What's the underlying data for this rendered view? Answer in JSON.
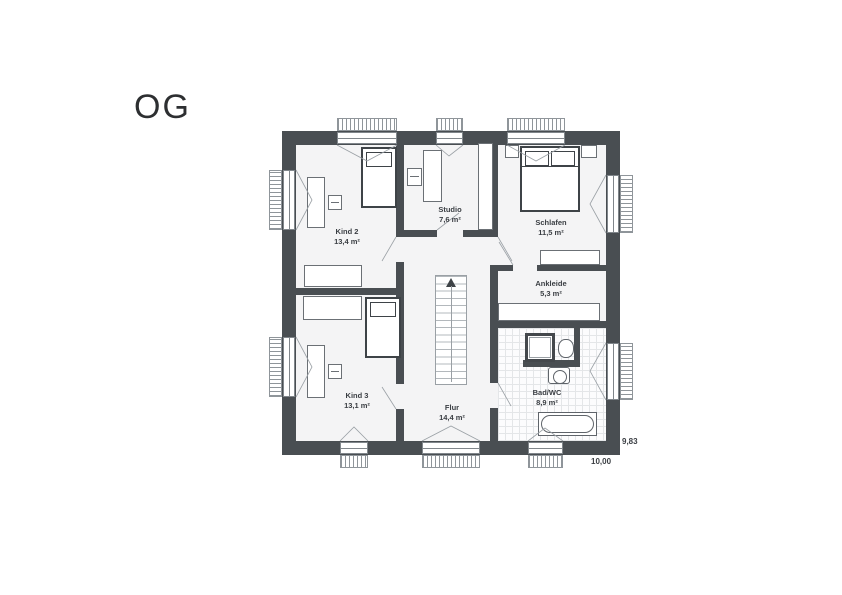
{
  "title": "OG",
  "rooms": [
    {
      "id": "kind2",
      "name": "Kind 2",
      "area": "13,4 m²"
    },
    {
      "id": "studio",
      "name": "Studio",
      "area": "7,6 m²"
    },
    {
      "id": "schlafen",
      "name": "Schlafen",
      "area": "11,5 m²"
    },
    {
      "id": "ankleide",
      "name": "Ankleide",
      "area": "5,3 m²"
    },
    {
      "id": "kind3",
      "name": "Kind 3",
      "area": "13,1 m²"
    },
    {
      "id": "flur",
      "name": "Flur",
      "area": "14,4 m²"
    },
    {
      "id": "badwc",
      "name": "Bad/WC",
      "area": "8,9 m²"
    }
  ],
  "dimensions": {
    "width": "10,00",
    "depth": "9,83"
  },
  "colors": {
    "wall": "#494e52",
    "floor": "#f4f4f5",
    "furniture_dark": "#3e4347",
    "thin_line": "#9aa0a5",
    "text": "#3a3e43"
  }
}
